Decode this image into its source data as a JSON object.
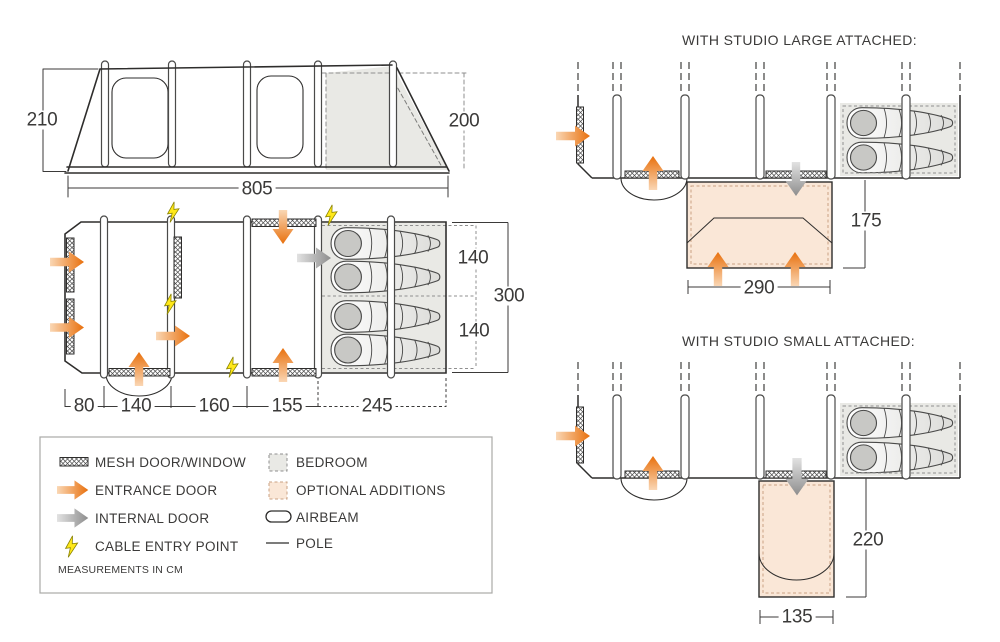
{
  "diagrams": {
    "studio_large_title": "WITH STUDIO LARGE ATTACHED:",
    "studio_small_title": "WITH STUDIO SMALL ATTACHED:"
  },
  "dimensions": {
    "elevation": {
      "left_height": "210",
      "right_height": "200",
      "length": "805"
    },
    "floorplan": {
      "right_upper": "140",
      "right_total": "300",
      "right_lower": "140",
      "bottom_1": "80",
      "bottom_2": "140",
      "bottom_3": "160",
      "bottom_4": "155",
      "bottom_5": "245"
    },
    "studio_large": {
      "depth": "175",
      "width": "290"
    },
    "studio_small": {
      "depth": "220",
      "width": "135"
    }
  },
  "legend": {
    "mesh": "MESH DOOR/WINDOW",
    "entrance": "ENTRANCE DOOR",
    "internal": "INTERNAL DOOR",
    "cable": "CABLE ENTRY POINT",
    "bedroom": "BEDROOM",
    "optional": "OPTIONAL ADDITIONS",
    "airbeam": "AIRBEAM",
    "pole": "POLE",
    "note": "MEASUREMENTS IN CM",
    "icons": [
      "mesh-swatch-icon",
      "entrance-arrow-icon",
      "internal-arrow-icon",
      "lightning-icon",
      "bedroom-swatch-icon",
      "optional-swatch-icon",
      "airbeam-icon",
      "pole-icon"
    ]
  },
  "colors": {
    "line": "#2e2d2c",
    "bedroom_fill": "#e9e9e5",
    "optional_fill": "#fae7d7",
    "entrance_orange": "#e8700d",
    "internal_grey": "#8d8d8d",
    "cable_yellow": "#ffe81a"
  }
}
